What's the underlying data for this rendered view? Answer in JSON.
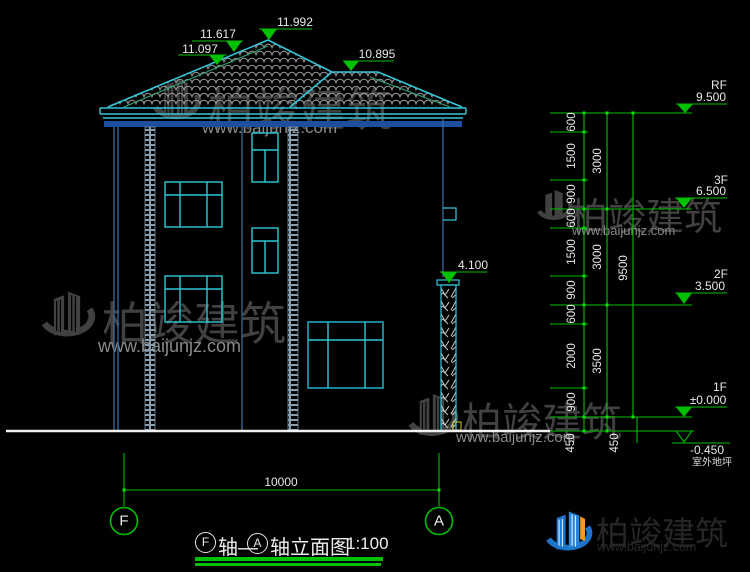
{
  "roof_marks": {
    "m11617": "11.617",
    "m11097": "11.097",
    "m11992": "11.992",
    "m10895": "10.895"
  },
  "wall_mark": {
    "m4100": "4.100"
  },
  "levels": {
    "rf": {
      "floor": "RF",
      "value": "9.500"
    },
    "f3": {
      "floor": "3F",
      "value": "6.500"
    },
    "f2": {
      "floor": "2F",
      "value": "3.500"
    },
    "f1": {
      "floor": "1F",
      "value": "±0.000"
    },
    "ground": {
      "value": "-0.450",
      "label": "室外地坪"
    }
  },
  "dims": {
    "small": [
      "600",
      "1500",
      "900",
      "600",
      "1500",
      "900",
      "600",
      "2000",
      "900",
      "450"
    ],
    "floors": [
      "3000",
      "3000",
      "3500",
      "450"
    ],
    "total": "9500",
    "width": "10000"
  },
  "axes": {
    "start": "F",
    "end": "A"
  },
  "title": {
    "seg1": "轴—",
    "seg2": "轴立面图",
    "scale": "1:100"
  },
  "watermark": {
    "brand": "柏竣建筑",
    "url": "www.baijunjz.com"
  },
  "colors": {
    "dim_green": "#00c000",
    "line_cyan": "#33c6d8",
    "wall_blue": "#3a6a99",
    "band_blue": "#1c4fa0"
  }
}
